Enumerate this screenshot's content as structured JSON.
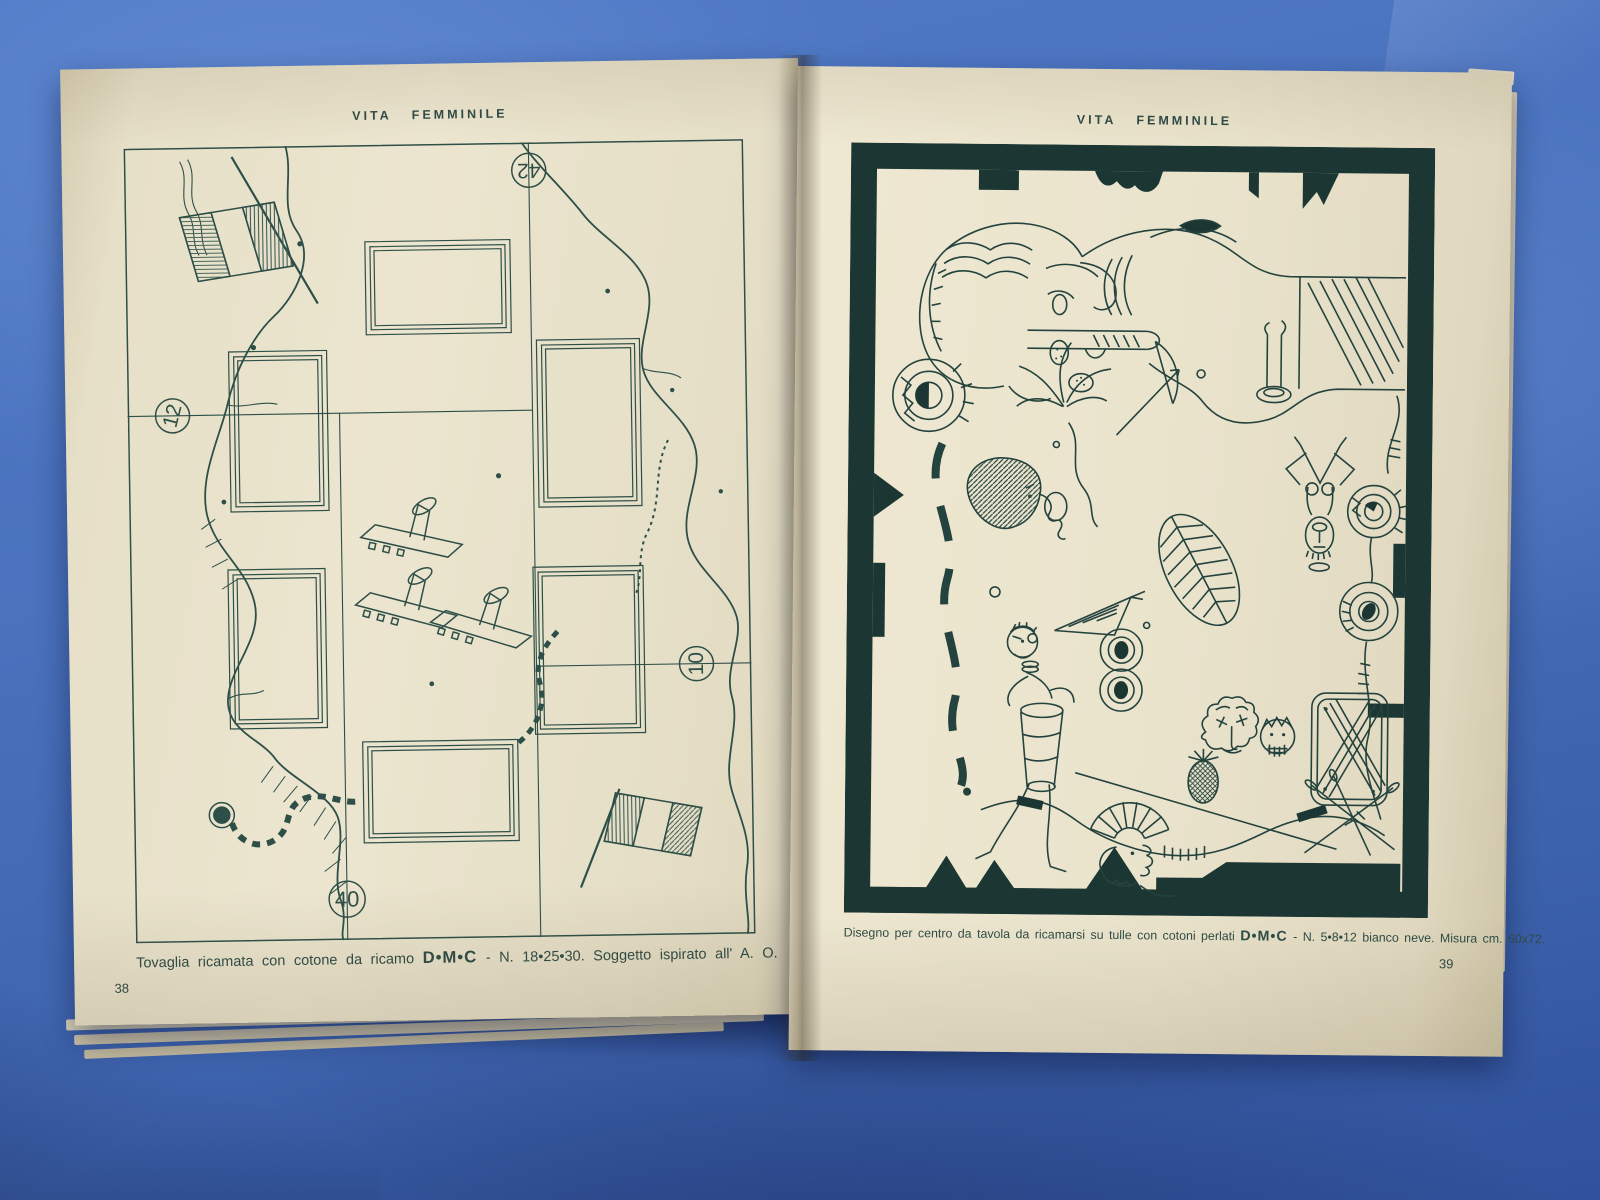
{
  "scene": {
    "background_color": "#4a72bd",
    "ink_color": "#2e4f48",
    "paper_color": "#e8e1ca"
  },
  "magazine": {
    "left_page": {
      "header": "VITA FEMMINILE",
      "page_number": "38",
      "plate": {
        "map_numbers": {
          "top": "42",
          "left": "12",
          "right": "10",
          "bottom": "40"
        }
      },
      "caption": {
        "prefix": "Tovaglia ricamata con cotone da ricamo",
        "brand": "D•M•C",
        "suffix": "- N. 18•25•30.  Soggetto ispirato all' A. O."
      }
    },
    "right_page": {
      "header": "VITA FEMMINILE",
      "page_number": "39",
      "caption": {
        "prefix": "Disegno per centro da tavola da ricamarsi su tulle con cotoni perlati",
        "brand": "D•M•C",
        "suffix": "- N. 5•8•12 bianco neve. Misura cm. 60x72."
      }
    }
  }
}
